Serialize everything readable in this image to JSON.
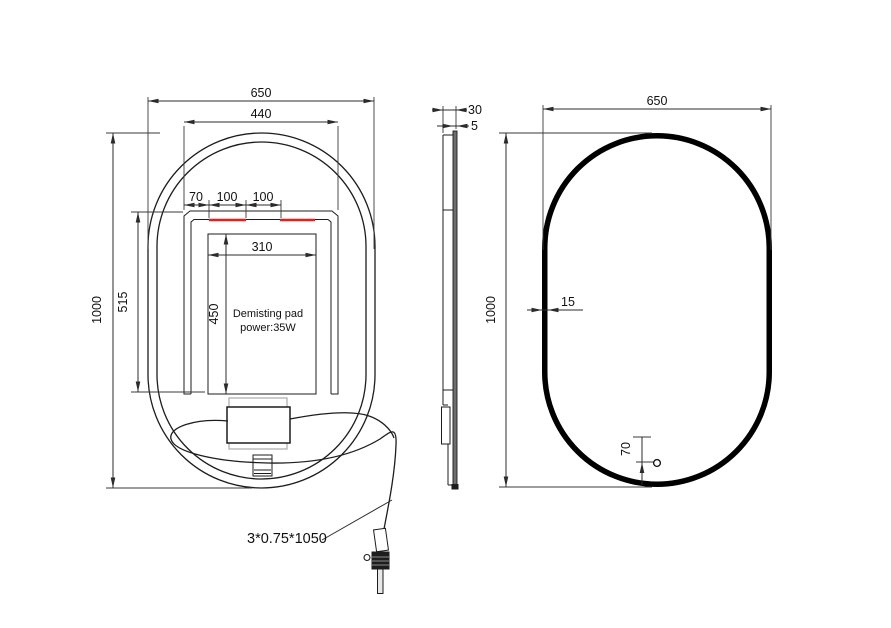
{
  "drawing": {
    "front_view": {
      "dim_overall_width": "650",
      "dim_top_inner_width": "440",
      "dim_offset": "70",
      "dim_touch_seg1": "100",
      "dim_touch_seg2": "100",
      "dim_pad_width": "310",
      "dim_pad_height": "450",
      "dim_backpanel_height": "515",
      "dim_overall_height": "1000",
      "pad_label_line1": "Demisting pad",
      "pad_label_line2": "power:35W",
      "cable_spec_label": "3*0.75*1050"
    },
    "side_view": {
      "dim_total_depth": "30",
      "dim_glass_thickness": "5"
    },
    "back_view": {
      "dim_overall_width": "650",
      "dim_overall_height": "1000",
      "dim_frame_width": "15",
      "dim_sensor_offset": "70"
    },
    "colors": {
      "line": "#1d1d1d",
      "dimension": "#2b2b2b",
      "highlight_red": "#ee1b1b",
      "panel_gray": "#b0b0b0",
      "background": "#ffffff"
    }
  }
}
